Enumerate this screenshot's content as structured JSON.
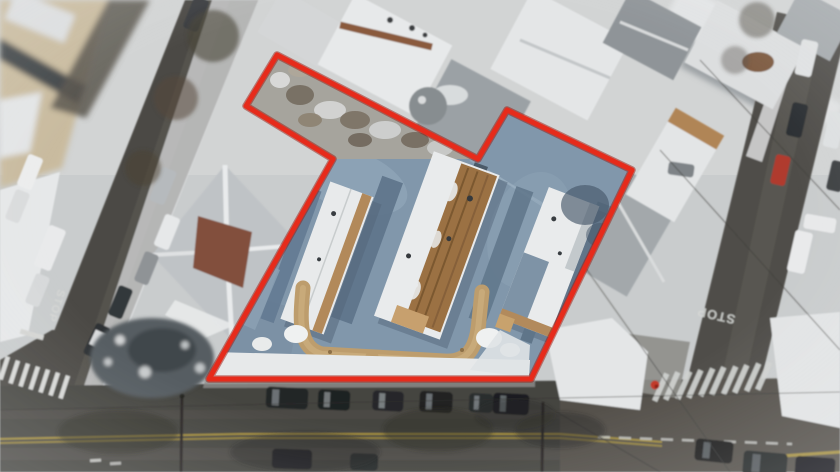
{
  "scene": {
    "type": "aerial-photograph",
    "season": "winter-snow",
    "description": "Overhead drone photo of a snowy corner lot with three long apartment buildings, outlined by a red property boundary, between two side streets and a main road with parked cars"
  },
  "boundary": {
    "points": "277,55 478,159 507,110 632,170 531,379 209,379 333,159 246,106",
    "color": "#e62b1b",
    "under_color": "#9c150b",
    "stroke_width": "5"
  },
  "road_markings": {
    "left_street_stop": "STOP",
    "right_street_stop": "STOP"
  },
  "palette": {
    "snow": "#e8eaeb",
    "asphalt": "#4b4a45",
    "parcel_blue_gray": "#8197ab",
    "wood_tan": "#b2895a",
    "roof_brown": "#9b7143",
    "hip_roof_brown": "#82503c",
    "yellow_center_line": "#a8923d",
    "hydrant_red": "#c23b2c"
  }
}
